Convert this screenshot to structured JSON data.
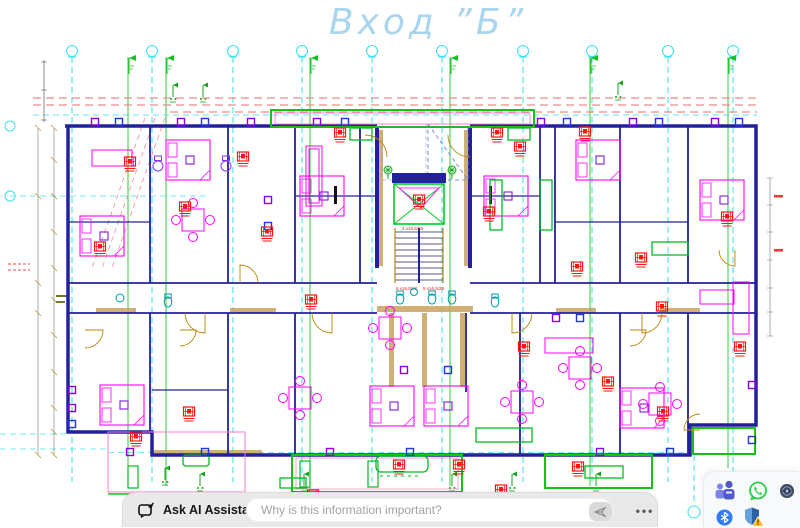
{
  "title": {
    "text": "Вход ”Б”"
  },
  "floor_plan": {
    "description": "apartment-building-floor-plan-entrance-B",
    "stair_labels": [
      "3 x16,5/28",
      "5 x16,5/28",
      "5 x16,5/28"
    ],
    "colors": {
      "grid_line": "#19dcEC",
      "section_line": "#1fc52a",
      "setback_dash": "#ee8c8c",
      "walls": "#23209b",
      "furniture": "#ff00ff",
      "tags": "#ff1414",
      "fixtures_green": "#00bb22",
      "fixtures_teal": "#0099aa",
      "doors": "#b8860b",
      "title_blue": "#a9d5ef"
    }
  },
  "assistant_bar": {
    "label": "Ask AI Assistant",
    "input_placeholder": "Why is this information important?",
    "more_label": "•••"
  },
  "tray": {
    "icons": [
      {
        "name": "teams"
      },
      {
        "name": "whatsapp"
      },
      {
        "name": "round-app"
      },
      {
        "name": "bluetooth"
      },
      {
        "name": "windows-security"
      }
    ]
  }
}
